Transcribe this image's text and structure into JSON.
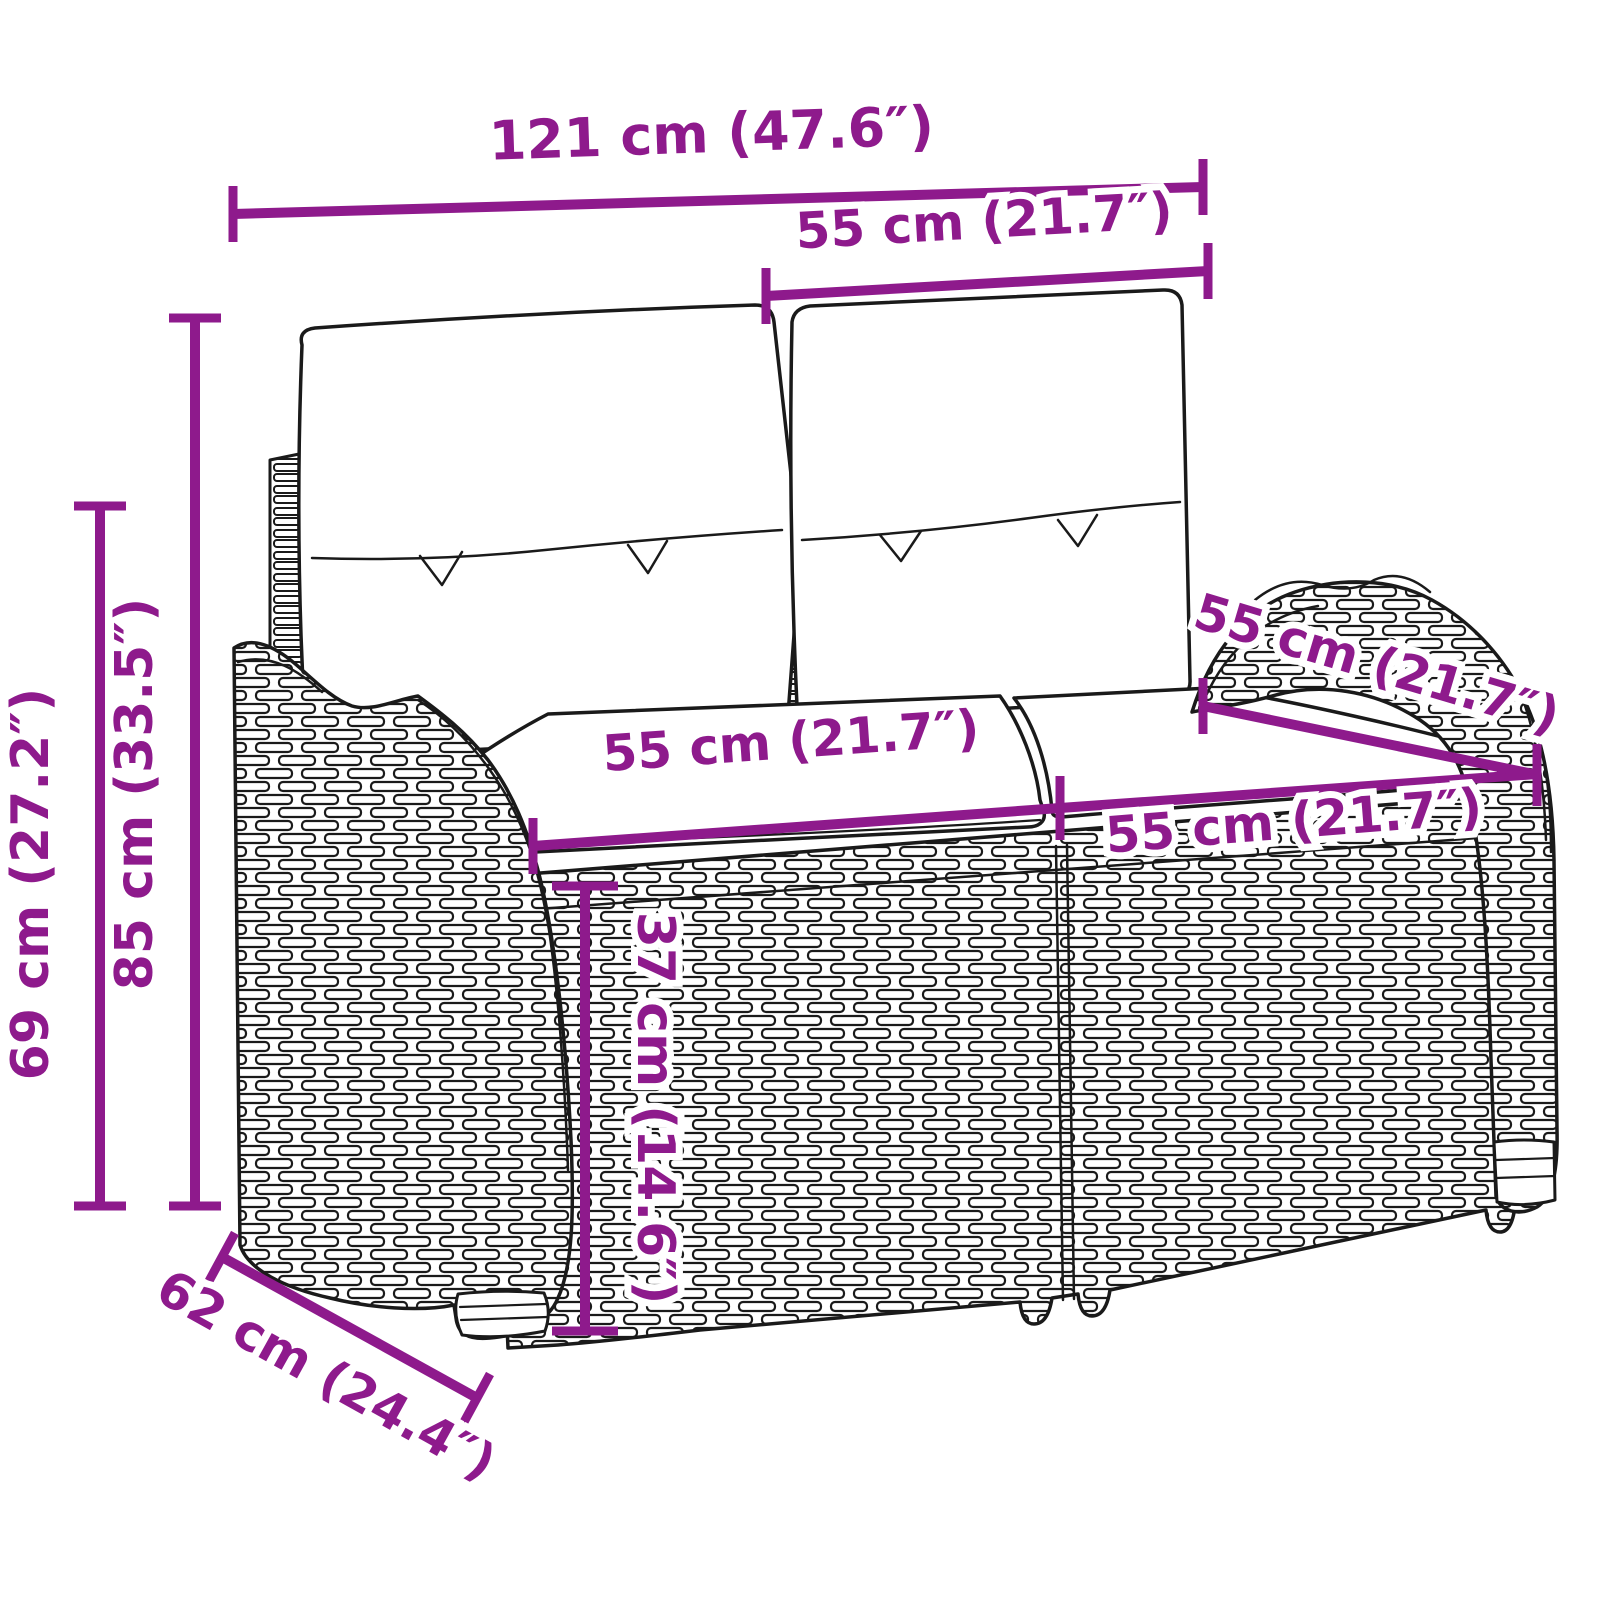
{
  "diagram": {
    "name": "rattan-garden-bench-dimension-diagram",
    "background": "#ffffff",
    "accent_color": "#8E1A8C",
    "outline_color": "#1a1a1a",
    "subject": "2-seater poly rattan garden bench with back and seat cushions",
    "dimensions": [
      {
        "id": "total_width",
        "label": "121 cm (47.6″)",
        "value_cm": 121,
        "value_in": 47.6
      },
      {
        "id": "back_cushion_width",
        "label": "55 cm (21.7″)",
        "value_cm": 55,
        "value_in": 21.7
      },
      {
        "id": "total_height",
        "label": "85 cm (33.5″)",
        "value_cm": 85,
        "value_in": 33.5
      },
      {
        "id": "arm_height",
        "label": "69 cm (27.2″)",
        "value_cm": 69,
        "value_in": 27.2
      },
      {
        "id": "seat_width_left",
        "label": "55 cm (21.7″)",
        "value_cm": 55,
        "value_in": 21.7
      },
      {
        "id": "seat_width_right",
        "label": "55 cm (21.7″)",
        "value_cm": 55,
        "value_in": 21.7
      },
      {
        "id": "seat_depth",
        "label": "55 cm (21.7″)",
        "value_cm": 55,
        "value_in": 21.7
      },
      {
        "id": "seat_height",
        "label": "37 cm (14.6″)",
        "value_cm": 37,
        "value_in": 14.6
      },
      {
        "id": "total_depth",
        "label": "62 cm (24.4″)",
        "value_cm": 62,
        "value_in": 24.4
      }
    ]
  }
}
